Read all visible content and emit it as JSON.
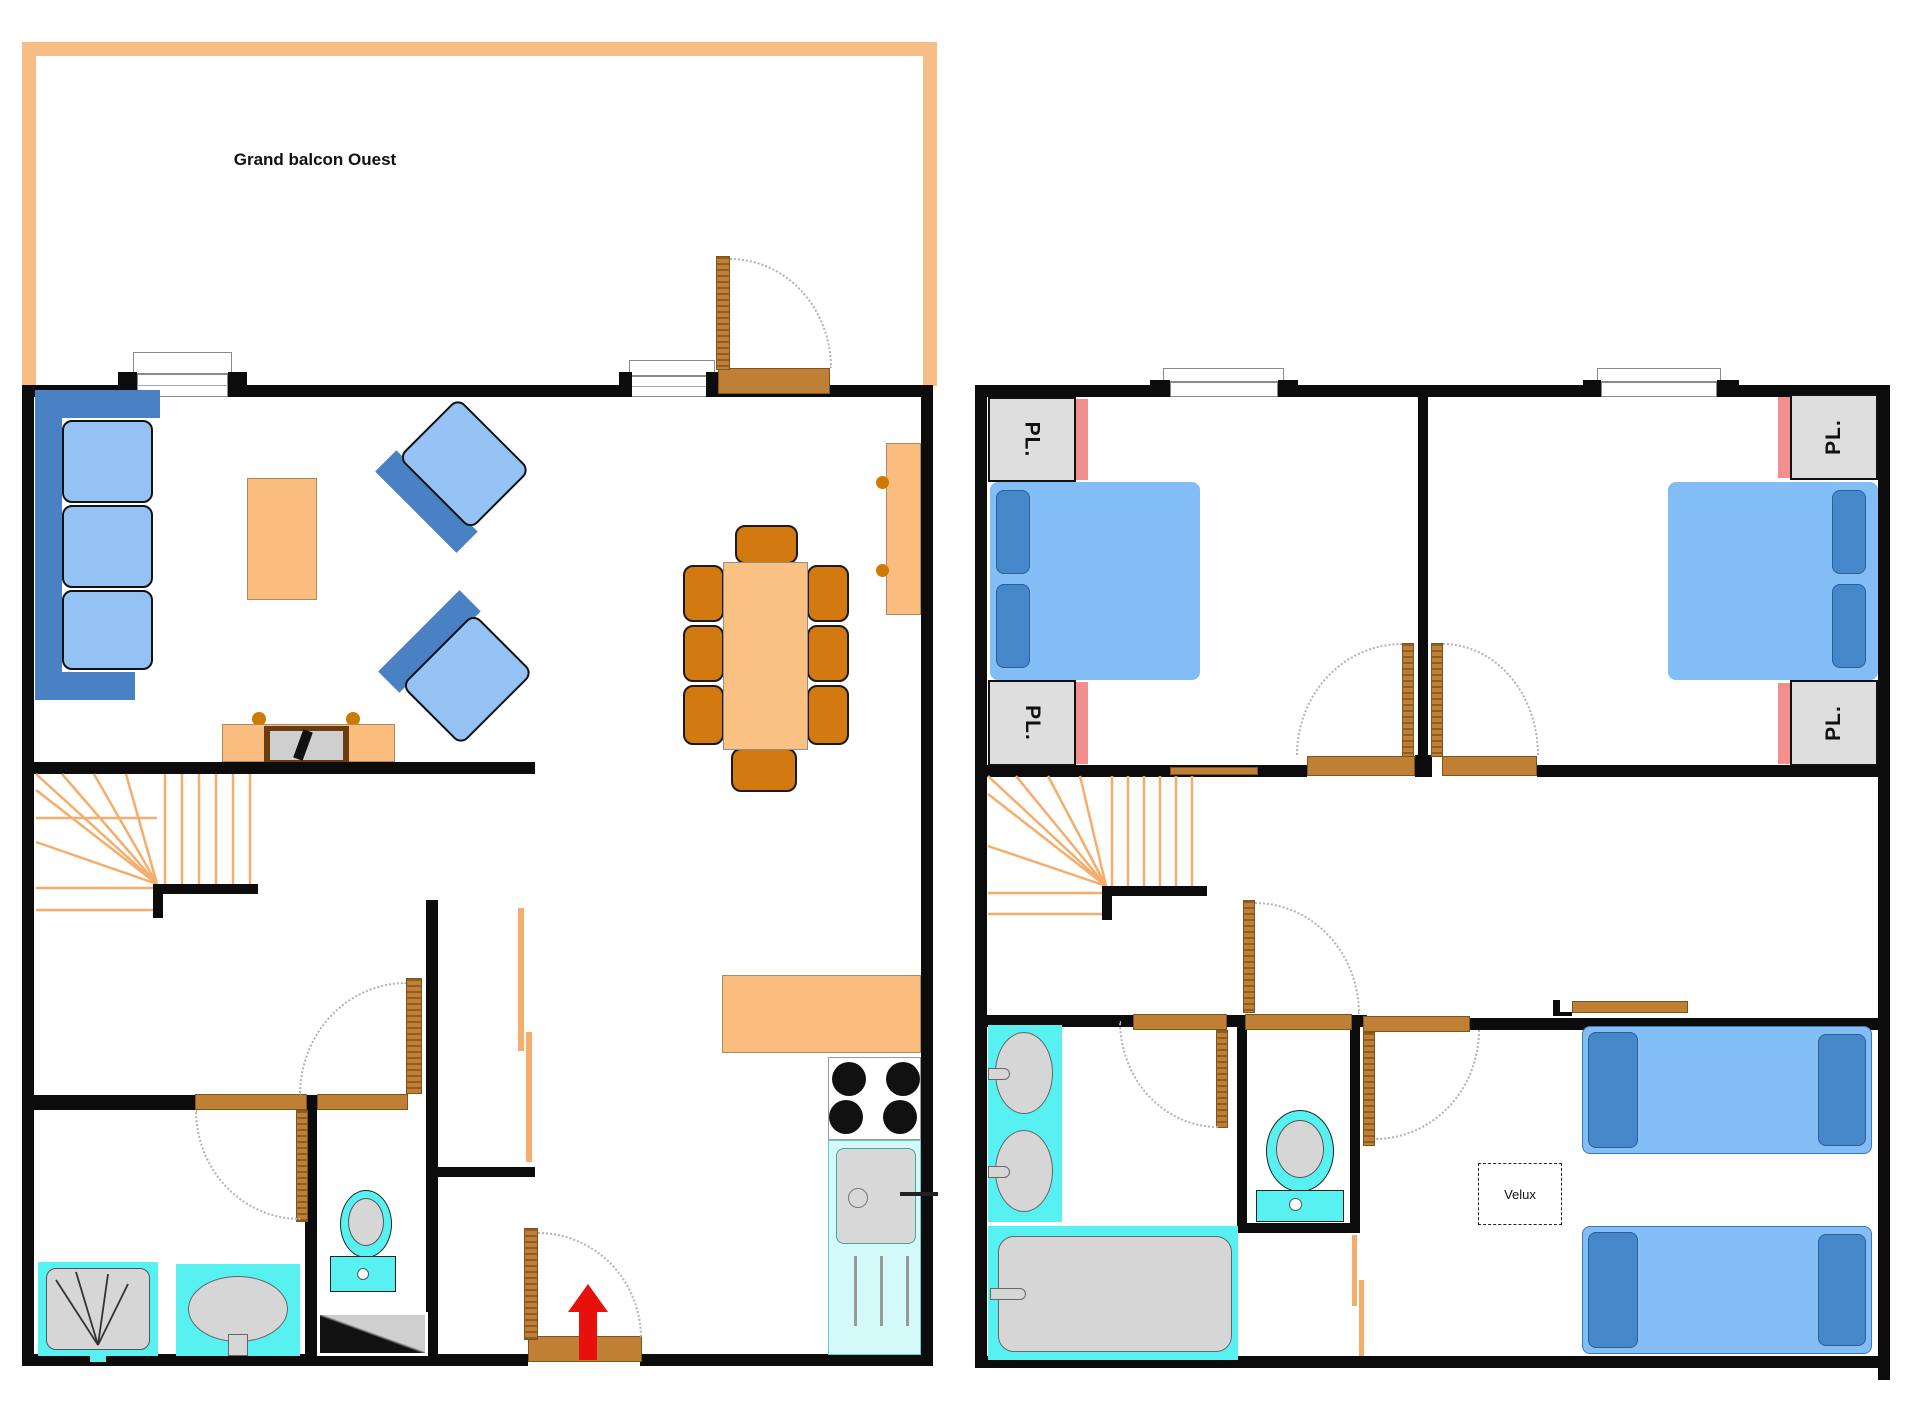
{
  "labels": {
    "balcony": "Grand balcon Ouest",
    "closet_abbrev": "PL.",
    "skylight": "Velux"
  },
  "colors": {
    "wall": "#0c0c0c",
    "balcony_border": "#f8bd84",
    "stair_steps": "#f5ad6c",
    "wood_doors": "#bf7f35",
    "furniture_orange": "#fbbd7d",
    "dining_chair_orange": "#d2790f",
    "sofa_frame_blue": "#4a80c4",
    "cushion_light_blue": "#94c2f4",
    "bed_light_blue": "#82bdf6",
    "pillow_dark_blue": "#4687ca",
    "sanitary_cyan": "#58f1f1",
    "kitchen_sink_pale_cyan": "#d4f9f9",
    "fixture_gray": "#d6d6d6",
    "closet_gray": "#dedede",
    "closet_pink_strip": "#f28e8e",
    "entrance_arrow_red": "#e8100c"
  },
  "floors": {
    "ground": {
      "name": "ground-floor-plan",
      "rooms": [
        "balcony",
        "living-room",
        "dining-area",
        "kitchen",
        "entrance-hall",
        "bathroom",
        "wc",
        "staircase"
      ]
    },
    "upper": {
      "name": "upper-floor-plan",
      "rooms": [
        "bedroom-1",
        "bedroom-2",
        "bedroom-3",
        "bathroom",
        "wc",
        "landing-dressing",
        "staircase"
      ]
    }
  }
}
